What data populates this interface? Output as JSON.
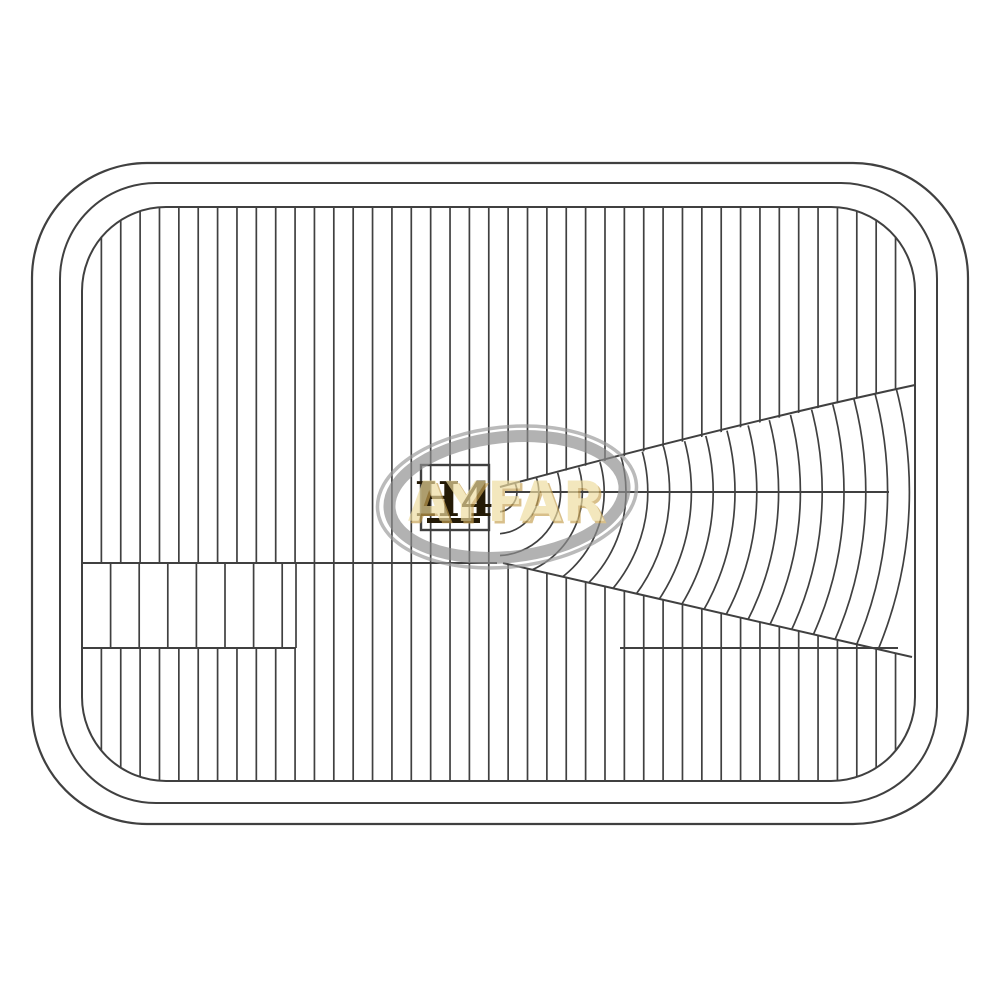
{
  "page": {
    "description": "Technical line drawing of a rectangular fluted headlight lens with brand watermark",
    "background": "#ffffff"
  },
  "drawing": {
    "type": "headlight-lens-technical-drawing",
    "lamp_type_marking": "H4",
    "brand_watermark": "AYFAR",
    "colors": {
      "bg": "#ffffff",
      "line": "#404040",
      "ink": "#241a06",
      "gold": "#eedc9f",
      "gold_shadow": "#c7a253",
      "swoosh": "#8f8f8f",
      "swoosh_thin": "#9a9a9a"
    },
    "pattern": {
      "outer_rim": {
        "x": 32,
        "y": 163,
        "w": 936,
        "h": 661,
        "r": 115,
        "sw": 2.2
      },
      "middle_rim": {
        "x": 60,
        "y": 183,
        "w": 877,
        "h": 620,
        "r": 96,
        "sw": 2
      },
      "inner_lens": {
        "x": 82,
        "y": 207,
        "w": 833,
        "h": 574,
        "r": 84,
        "sw": 2
      },
      "flutes": {
        "spacing": 19.37,
        "sw": 1.7
      },
      "block_band": {
        "x1": 82,
        "x2": 296,
        "y1": 563,
        "y2": 648,
        "spacing": 28.6,
        "top_line_x2": 497,
        "sw": 2
      },
      "fan": {
        "cx": 497,
        "cy": 492,
        "r_start": 20,
        "r_step": 21.8,
        "count": 19,
        "clip_poly": "500,487 915,384 915,657 500,563",
        "top_edge": "M500,487 Q730,425 915,385",
        "bottom_edge": "M503,563 L912,657",
        "mid_line": {
          "x1": 505,
          "y": 492,
          "x2": 889
        },
        "arc_sw": 1.7,
        "edge_sw": 2
      },
      "right_h_line": {
        "x1": 620,
        "x2": 898,
        "y": 648,
        "sw": 2
      }
    },
    "h4_marking": {
      "box": {
        "x": 421,
        "y": 465,
        "w": 68,
        "h": 65,
        "sw": 2.4
      },
      "text_x": 454,
      "text_y": 516,
      "underline": {
        "x": 427,
        "y": 518,
        "w": 53,
        "h": 5
      }
    },
    "watermark": {
      "opacity": 0.68,
      "center_x": 507,
      "center_y": 497,
      "rotation": -6,
      "ellipse_thick": {
        "rx": 118,
        "ry": 60,
        "sw": 12
      },
      "ellipse_thin": {
        "rx": 130,
        "ry": 70,
        "sw": 3.5
      },
      "text_x": 507,
      "text_y": 521,
      "shadow_dx": 2.5,
      "shadow_dy": 2.5
    }
  }
}
